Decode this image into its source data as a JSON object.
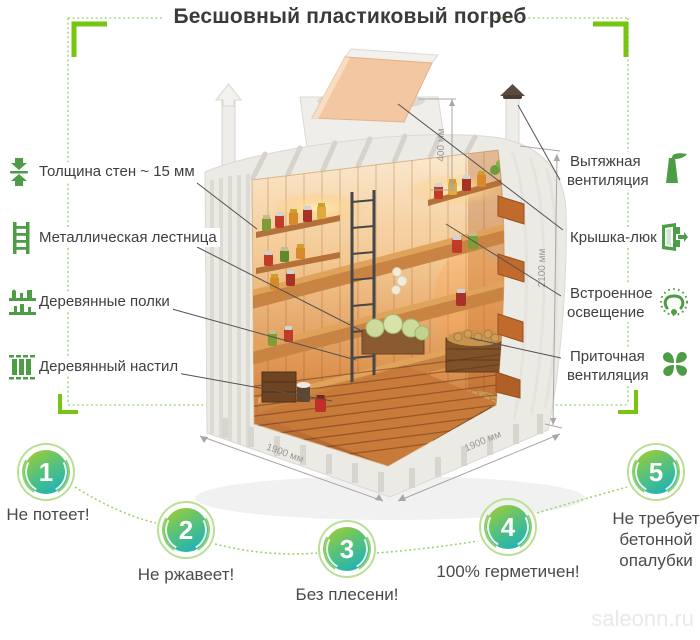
{
  "title": "Бесшовный пластиковый погреб",
  "labels_left": [
    {
      "icon": "wall-thickness-icon",
      "text": "Толщина стен ~ 15 мм"
    },
    {
      "icon": "ladder-icon",
      "text": "Металлическая лестница"
    },
    {
      "icon": "shelves-icon",
      "text": "Деревянные полки"
    },
    {
      "icon": "flooring-icon",
      "text": "Деревянный настил"
    }
  ],
  "labels_right": [
    {
      "icon": "exhaust-vent-icon",
      "text": "Вытяжная вентиляция"
    },
    {
      "icon": "hatch-icon",
      "text": "Крышка-люк"
    },
    {
      "icon": "light-icon",
      "text": "Встроенное освещение"
    },
    {
      "icon": "supply-vent-icon",
      "text": "Приточная вентиляция"
    }
  ],
  "dimensions": {
    "lid_height": "400 мм",
    "height": "2100 мм",
    "width": "1900 мм",
    "depth": "1900 мм"
  },
  "features": [
    {
      "number": "1",
      "text": "Не потеет!"
    },
    {
      "number": "2",
      "text": "Не ржавеет!"
    },
    {
      "number": "3",
      "text": "Без плесени!"
    },
    {
      "number": "4",
      "text": "100% герметичен!"
    },
    {
      "number": "5",
      "text": "Не требует бетонной опалубки"
    }
  ],
  "watermark": "saleonn.ru",
  "colors": {
    "accent_green": "#77c510",
    "dotted_green": "#a8d985",
    "icon_green": "#4d9d46",
    "circle_ring": "#b9e095",
    "circle_gradient_top": "#92cb40",
    "circle_gradient_bottom": "#1fb2b7",
    "text_dark": "#3f3f3f",
    "dimension_gray": "#9b9792"
  }
}
